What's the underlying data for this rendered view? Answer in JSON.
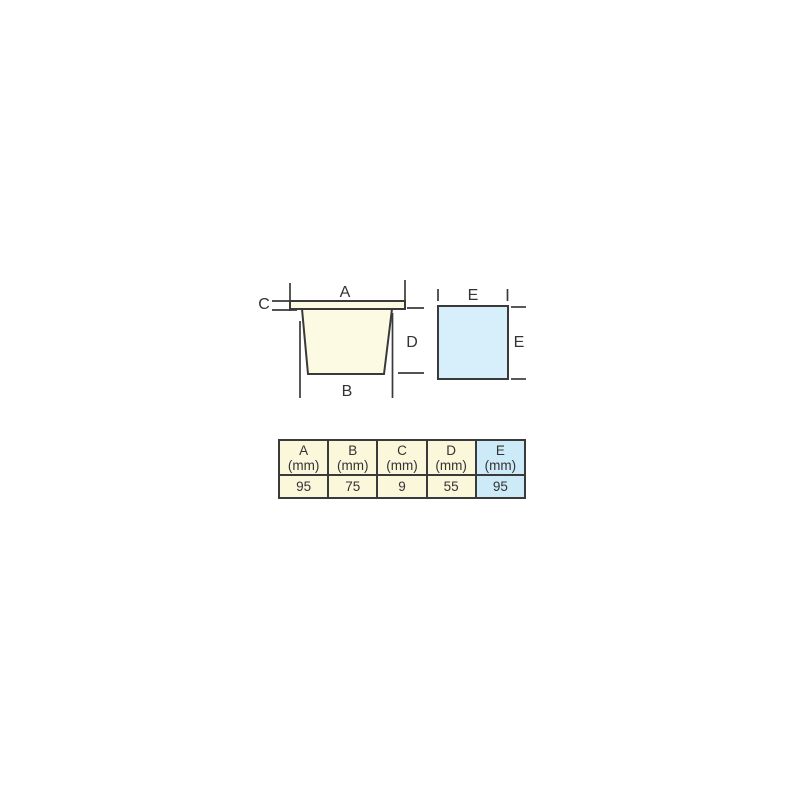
{
  "figure": {
    "pot": {
      "label_a": "A",
      "label_b": "B",
      "label_c": "C",
      "label_d": "D",
      "fill": "#FCFAE3"
    },
    "square": {
      "label_e_top": "E",
      "label_e_side": "E",
      "fill": "#D7EFFA"
    },
    "outline_color": "#3a3a3a",
    "text_color": "#333333"
  },
  "table": {
    "cream_bg": "#FBF7DA",
    "highlight_bg": "#CDEAF8",
    "columns": [
      {
        "name": "A",
        "unit": "(mm)",
        "value": "95"
      },
      {
        "name": "B",
        "unit": "(mm)",
        "value": "75"
      },
      {
        "name": "C",
        "unit": "(mm)",
        "value": "9"
      },
      {
        "name": "D",
        "unit": "(mm)",
        "value": "55"
      },
      {
        "name": "E",
        "unit": "(mm)",
        "value": "95"
      }
    ]
  }
}
